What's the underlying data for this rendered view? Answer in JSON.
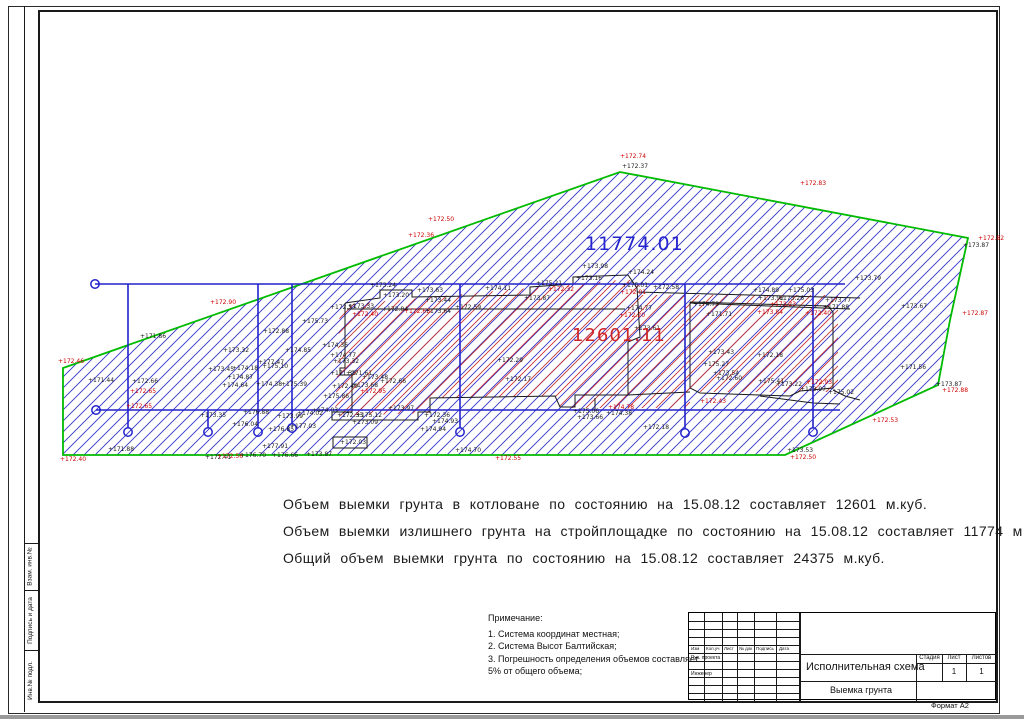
{
  "page": {
    "format_label": "Формат А2"
  },
  "side_strip": {
    "labels": [
      "Взам. инв.№",
      "Подпись и дата",
      "Инв.№ подл."
    ]
  },
  "summary": {
    "lines": [
      "Объем выемки грунта в котловане по состоянию на 15.08.12 составляет 12601 м.куб.",
      "Объем выемки излишнего грунта на стройплощадке по состоянию на 15.08.12 составляет 11774 м.куб.",
      "Общий объем выемки грунта по состоянию на 15.08.12 составляет 24375 м.куб."
    ]
  },
  "notes": {
    "title": "Примечание:",
    "items": [
      "1. Система координат местная;",
      "2. Система Высот Балтийская;",
      "3. Погрешность определения объемов составляет",
      "5% от общего объема;"
    ]
  },
  "title_block": {
    "header_cols": [
      "Изм",
      "Кол.уч",
      "Лист",
      "№ док",
      "Подпись",
      "Дата"
    ],
    "row1": "Рук. проекта",
    "row2": "Инженер",
    "doc_title": "Исполнительная схема",
    "doc_subtitle": "Выемка грунта",
    "stage_label": "Стадия",
    "sheet_label": "Лист",
    "sheets_label": "Листов",
    "sheet_value": "1",
    "sheets_value": "1"
  },
  "drawing": {
    "colors": {
      "boundary": "#00bb00",
      "axis": "#2222cc",
      "hatch_blue": "#3333cc",
      "hatch_red": "#cc3333",
      "outline": "#1a1a1a",
      "label_black": "#1a1a1a",
      "label_red": "#cc0000"
    },
    "big_labels": [
      {
        "x": 585,
        "y": 250,
        "t": "11774.01",
        "c": "#2525cf",
        "s": 19
      },
      {
        "x": 572,
        "y": 341,
        "t": "12601.11",
        "c": "#cf2525",
        "s": 18
      }
    ],
    "site_boundary": [
      [
        63,
        455
      ],
      [
        63,
        368
      ],
      [
        620,
        172
      ],
      [
        968,
        238
      ],
      [
        950,
        320
      ],
      [
        938,
        385
      ],
      [
        785,
        455
      ]
    ],
    "red_zone": [
      [
        340,
        305
      ],
      [
        620,
        280
      ],
      [
        640,
        280
      ],
      [
        640,
        295
      ],
      [
        838,
        295
      ],
      [
        838,
        392
      ],
      [
        690,
        392
      ],
      [
        690,
        408
      ],
      [
        560,
        408
      ],
      [
        555,
        396
      ],
      [
        430,
        398
      ],
      [
        430,
        413
      ],
      [
        335,
        416
      ]
    ],
    "axis_h": [
      {
        "x1": 95,
        "y1": 284,
        "x2": 845,
        "y2": 284
      },
      {
        "x1": 96,
        "y1": 410,
        "x2": 840,
        "y2": 410
      }
    ],
    "axis_v": [
      {
        "x": 128,
        "y1": 284,
        "y2": 428
      },
      {
        "x": 208,
        "y1": 410,
        "y2": 428
      },
      {
        "x": 258,
        "y1": 284,
        "y2": 428
      },
      {
        "x": 292,
        "y1": 284,
        "y2": 424
      },
      {
        "x": 460,
        "y1": 284,
        "y2": 428
      },
      {
        "x": 685,
        "y1": 284,
        "y2": 429
      },
      {
        "x": 813,
        "y1": 288,
        "y2": 428
      }
    ],
    "axis_circles": [
      [
        95,
        284
      ],
      [
        96,
        410
      ],
      [
        128,
        432
      ],
      [
        208,
        432
      ],
      [
        258,
        432
      ],
      [
        292,
        428
      ],
      [
        460,
        432
      ],
      [
        685,
        433
      ],
      [
        813,
        432
      ]
    ],
    "outlines": [
      [
        [
          345,
          303
        ],
        [
          380,
          298
        ],
        [
          380,
          290
        ],
        [
          412,
          290
        ],
        [
          412,
          297
        ],
        [
          530,
          295
        ],
        [
          530,
          287
        ],
        [
          573,
          284
        ],
        [
          573,
          277
        ],
        [
          628,
          275
        ],
        [
          637,
          288
        ],
        [
          640,
          337
        ],
        [
          628,
          342
        ],
        [
          628,
          395
        ]
      ],
      [
        [
          345,
          303
        ],
        [
          345,
          368
        ],
        [
          340,
          368
        ],
        [
          340,
          375
        ],
        [
          352,
          375
        ],
        [
          352,
          412
        ],
        [
          332,
          412
        ],
        [
          332,
          420
        ],
        [
          418,
          420
        ],
        [
          418,
          412
        ],
        [
          430,
          412
        ],
        [
          430,
          398
        ],
        [
          555,
          396
        ],
        [
          560,
          407
        ],
        [
          575,
          407
        ],
        [
          575,
          395
        ],
        [
          628,
          395
        ]
      ],
      [
        [
          347,
          309
        ],
        [
          625,
          309
        ]
      ],
      [
        [
          637,
          292
        ],
        [
          860,
          298
        ]
      ],
      [
        [
          690,
          303
        ],
        [
          850,
          309
        ]
      ],
      [
        [
          690,
          302
        ],
        [
          828,
          306
        ],
        [
          833,
          312
        ],
        [
          833,
          388
        ],
        [
          800,
          391
        ],
        [
          790,
          396
        ],
        [
          700,
          393
        ],
        [
          690,
          388
        ],
        [
          690,
          302
        ]
      ],
      [
        [
          628,
          395
        ],
        [
          690,
          392
        ]
      ],
      [
        [
          833,
          390
        ],
        [
          845,
          396
        ],
        [
          860,
          400
        ]
      ],
      [
        [
          760,
          396
        ],
        [
          790,
          400
        ],
        [
          813,
          403
        ],
        [
          840,
          404
        ]
      ],
      [
        [
          333,
          437
        ],
        [
          367,
          437
        ],
        [
          367,
          448
        ],
        [
          333,
          448
        ],
        [
          333,
          437
        ]
      ],
      [
        [
          595,
          398
        ],
        [
          595,
          410
        ],
        [
          690,
          410
        ]
      ]
    ],
    "labels": [
      [
        620,
        158,
        "+172.74",
        "r"
      ],
      [
        622,
        168,
        "+172.37",
        "k"
      ],
      [
        800,
        185,
        "+172.83",
        "r"
      ],
      [
        408,
        237,
        "+172.36",
        "r"
      ],
      [
        428,
        221,
        "+172.50",
        "r"
      ],
      [
        210,
        304,
        "+172.90",
        "r"
      ],
      [
        58,
        363,
        "+172.46",
        "r"
      ],
      [
        88,
        382,
        "+171.44",
        "k"
      ],
      [
        140,
        338,
        "+171.86",
        "k"
      ],
      [
        132,
        383,
        "+172.66",
        "k"
      ],
      [
        130,
        393,
        "+172.65",
        "r"
      ],
      [
        126,
        408,
        "+172.65",
        "r"
      ],
      [
        108,
        451,
        "+171.88",
        "k"
      ],
      [
        60,
        461,
        "+172.40",
        "r"
      ],
      [
        205,
        459,
        "+172.41",
        "k"
      ],
      [
        217,
        458,
        "+172.56",
        "r"
      ],
      [
        240,
        457,
        "+176.70",
        "k"
      ],
      [
        262,
        448,
        "+177.91",
        "k"
      ],
      [
        272,
        457,
        "+176.66",
        "k"
      ],
      [
        306,
        456,
        "+173.87",
        "k"
      ],
      [
        223,
        352,
        "+173.32",
        "k"
      ],
      [
        208,
        371,
        "+173.45",
        "k"
      ],
      [
        232,
        370,
        "+174.18",
        "k"
      ],
      [
        262,
        368,
        "+175.10",
        "k"
      ],
      [
        227,
        379,
        "+174.87",
        "k"
      ],
      [
        222,
        387,
        "+174.64",
        "k"
      ],
      [
        285,
        352,
        "+174.85",
        "k"
      ],
      [
        302,
        323,
        "+175.73",
        "k"
      ],
      [
        263,
        333,
        "+172.88",
        "k"
      ],
      [
        258,
        364,
        "+177.47",
        "k"
      ],
      [
        256,
        386,
        "+174.38",
        "k"
      ],
      [
        281,
        386,
        "+175.39",
        "k"
      ],
      [
        200,
        417,
        "+173.35",
        "k"
      ],
      [
        243,
        414,
        "+176.88",
        "k"
      ],
      [
        232,
        426,
        "+176.04",
        "k"
      ],
      [
        277,
        418,
        "+173.99",
        "k"
      ],
      [
        297,
        415,
        "+174.02",
        "k"
      ],
      [
        268,
        431,
        "+176.85",
        "k"
      ],
      [
        290,
        428,
        "+177.03",
        "k"
      ],
      [
        330,
        309,
        "+172.57",
        "k"
      ],
      [
        348,
        308,
        "+173.33",
        "k"
      ],
      [
        352,
        316,
        "+172.40",
        "r"
      ],
      [
        370,
        287,
        "+173.24",
        "k"
      ],
      [
        383,
        297,
        "+173.20",
        "k"
      ],
      [
        417,
        292,
        "+173.63",
        "k"
      ],
      [
        382,
        311,
        "+172.84",
        "k"
      ],
      [
        404,
        313,
        "+172.63",
        "r"
      ],
      [
        425,
        313,
        "+173.64",
        "k"
      ],
      [
        425,
        302,
        "+173.44",
        "k"
      ],
      [
        455,
        309,
        "+172.59",
        "k"
      ],
      [
        485,
        290,
        "+174.11",
        "k"
      ],
      [
        524,
        300,
        "+173.87",
        "k"
      ],
      [
        536,
        285,
        "+175.21",
        "k"
      ],
      [
        548,
        291,
        "+172.32",
        "r"
      ],
      [
        582,
        268,
        "+173.98",
        "k"
      ],
      [
        628,
        274,
        "+174.24",
        "k"
      ],
      [
        576,
        280,
        "+173.16",
        "k"
      ],
      [
        622,
        287,
        "+175.01",
        "k"
      ],
      [
        620,
        294,
        "+172.01",
        "r"
      ],
      [
        626,
        310,
        "+174.77",
        "k"
      ],
      [
        619,
        317,
        "+172.20",
        "r"
      ],
      [
        634,
        330,
        "+173.61",
        "k"
      ],
      [
        322,
        347,
        "+174.36",
        "k"
      ],
      [
        330,
        357,
        "+174.77",
        "k"
      ],
      [
        333,
        363,
        "+173.32",
        "k"
      ],
      [
        497,
        362,
        "+172.29",
        "k"
      ],
      [
        505,
        381,
        "+172.17",
        "k"
      ],
      [
        330,
        375,
        "+171.38",
        "k"
      ],
      [
        346,
        375,
        "+171.61",
        "k"
      ],
      [
        362,
        379,
        "+173.48",
        "k"
      ],
      [
        380,
        383,
        "+172.66",
        "k"
      ],
      [
        332,
        388,
        "+172.49",
        "k"
      ],
      [
        352,
        387,
        "+173.68",
        "k"
      ],
      [
        360,
        393,
        "+172.95",
        "r"
      ],
      [
        323,
        398,
        "+175.86",
        "k"
      ],
      [
        388,
        410,
        "+173.97",
        "k"
      ],
      [
        337,
        417,
        "+172.33",
        "k"
      ],
      [
        356,
        417,
        "+175.12",
        "k"
      ],
      [
        352,
        424,
        "+173.09",
        "k"
      ],
      [
        340,
        444,
        "+172.03",
        "k"
      ],
      [
        312,
        412,
        "+174.03",
        "k"
      ],
      [
        424,
        417,
        "+172.36",
        "k"
      ],
      [
        432,
        423,
        "+174.93",
        "k"
      ],
      [
        420,
        431,
        "+174.94",
        "k"
      ],
      [
        455,
        452,
        "+174.70",
        "k"
      ],
      [
        495,
        460,
        "+172.55",
        "r"
      ],
      [
        573,
        413,
        "+175.06",
        "k"
      ],
      [
        577,
        419,
        "+173.66",
        "k"
      ],
      [
        606,
        415,
        "+174.38",
        "k"
      ],
      [
        608,
        409,
        "+174.78",
        "r"
      ],
      [
        643,
        429,
        "+172.18",
        "k"
      ],
      [
        653,
        289,
        "+172.58",
        "k"
      ],
      [
        753,
        292,
        "+174.89",
        "k"
      ],
      [
        788,
        292,
        "+175.03",
        "k"
      ],
      [
        758,
        300,
        "+173.92",
        "k"
      ],
      [
        778,
        300,
        "+173.26",
        "k"
      ],
      [
        770,
        306,
        "+173.23",
        "r"
      ],
      [
        825,
        302,
        "+173.77",
        "k"
      ],
      [
        823,
        309,
        "+171.88",
        "k"
      ],
      [
        693,
        306,
        "+174.73",
        "k"
      ],
      [
        706,
        316,
        "+171.71",
        "k"
      ],
      [
        757,
        314,
        "+173.84",
        "r"
      ],
      [
        805,
        315,
        "+172.40",
        "r"
      ],
      [
        708,
        354,
        "+173.43",
        "k"
      ],
      [
        757,
        357,
        "+172.18",
        "k"
      ],
      [
        703,
        366,
        "+175.27",
        "k"
      ],
      [
        713,
        375,
        "+173.54",
        "k"
      ],
      [
        716,
        380,
        "+172.60",
        "k"
      ],
      [
        758,
        383,
        "+175.41",
        "k"
      ],
      [
        776,
        386,
        "+173.22",
        "k"
      ],
      [
        806,
        384,
        "+172.93",
        "r"
      ],
      [
        800,
        391,
        "+173.97",
        "k"
      ],
      [
        828,
        394,
        "+175.02",
        "k"
      ],
      [
        700,
        403,
        "+172.43",
        "r"
      ],
      [
        855,
        280,
        "+173.79",
        "k"
      ],
      [
        978,
        240,
        "+172.82",
        "r"
      ],
      [
        963,
        247,
        "+173.87",
        "k"
      ],
      [
        962,
        315,
        "+172.87",
        "r"
      ],
      [
        901,
        308,
        "+173.67",
        "k"
      ],
      [
        900,
        369,
        "+171.56",
        "k"
      ],
      [
        936,
        386,
        "+173.87",
        "k"
      ],
      [
        942,
        392,
        "+172.88",
        "r"
      ],
      [
        872,
        422,
        "+172.53",
        "r"
      ],
      [
        787,
        452,
        "+173.53",
        "k"
      ],
      [
        790,
        459,
        "+172.50",
        "r"
      ]
    ]
  }
}
